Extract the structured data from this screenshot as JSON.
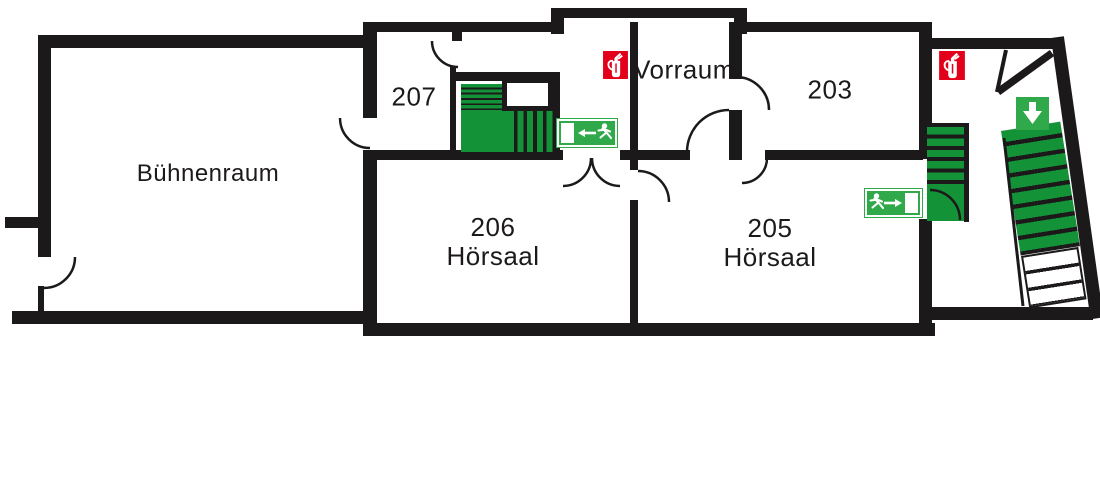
{
  "rooms": {
    "stage": {
      "label": "Bühnenraum"
    },
    "r207": {
      "label": "207"
    },
    "vorraum": {
      "label": "Vorraum"
    },
    "r203": {
      "label": "203"
    },
    "r206": {
      "label": "206",
      "type": "Hörsaal"
    },
    "r205": {
      "label": "205",
      "type": "Hörsaal"
    }
  },
  "icons": {
    "extinguisher_vorraum": "fire-extinguisher",
    "extinguisher_stairwell": "fire-extinguisher",
    "exit_sign_central": "emergency-exit-run-left",
    "exit_sign_right": "emergency-exit-run-right",
    "down_sign": "direction-down-arrow"
  },
  "stairs": {
    "central": {
      "upper_steps": 5,
      "lower_steps": 5,
      "landing": true
    },
    "right_small": {
      "steps": 5,
      "landing": true
    },
    "right_main": {
      "green_steps": 8,
      "white_steps": 3
    }
  },
  "colors": {
    "wall": "#1c191b",
    "stair_green": "#149238",
    "sign_green": "#2fa94a",
    "extinguisher_red": "#e2001a",
    "background": "#ffffff"
  }
}
